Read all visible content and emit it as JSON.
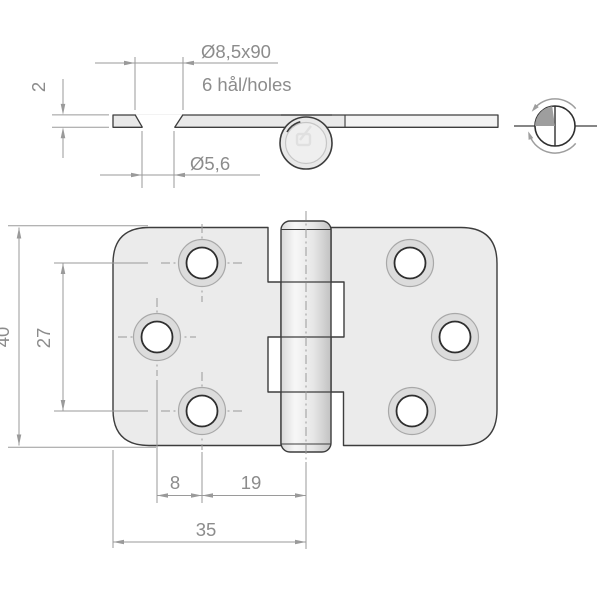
{
  "side_view": {
    "countersink_dim": "Ø8,5x90",
    "holes_note": "6 hål/holes",
    "thickness_dim": "2",
    "hole_dim": "Ø5,6"
  },
  "front_view": {
    "height_dim": "40",
    "hole_spacing_dim": "27",
    "hole_offset_dim": "8",
    "hole_to_axis_dim": "19",
    "leaf_width_dim": "35"
  },
  "colors": {
    "background": "#ffffff",
    "outline": "#3d3d3d",
    "metal_fill": "#ebebeb",
    "metal_light": "#f3f3f3",
    "ring_fill": "#dcdcdc",
    "ring_stroke": "#a8a8a8",
    "dimension": "#9a9a9a",
    "dimension_text": "#8c8c8c"
  }
}
